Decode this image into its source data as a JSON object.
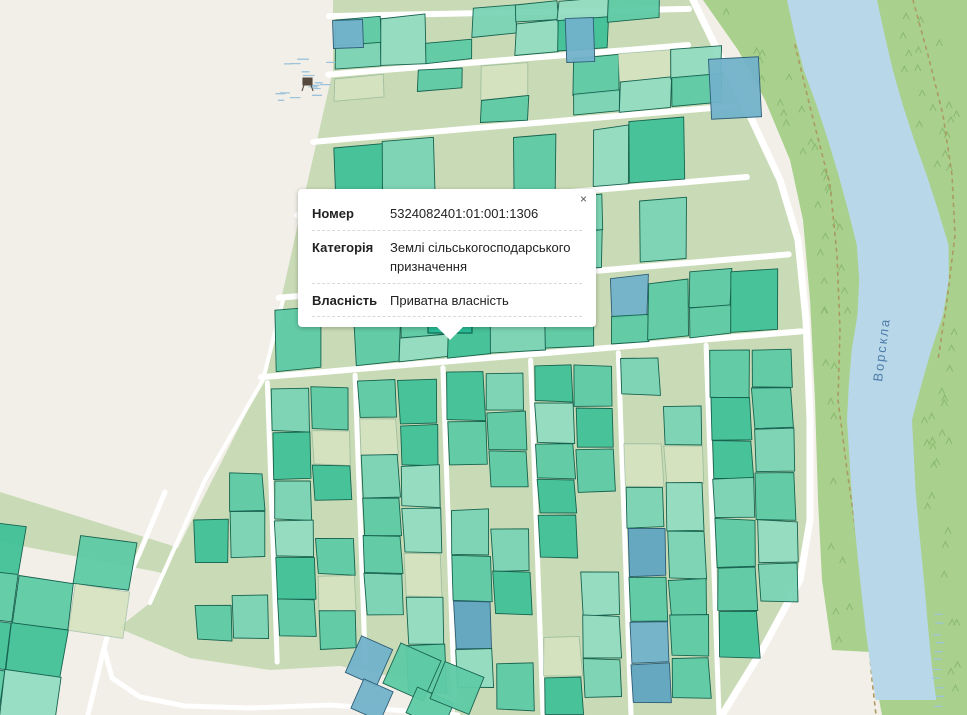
{
  "popup": {
    "close_label": "×",
    "rows": [
      {
        "label": "Номер",
        "value": "5324082401:01:001:1306"
      },
      {
        "label": "Категорія",
        "value": "Землі сільськогосподарського призначення"
      },
      {
        "label": "Власність",
        "value": "Приватна власність"
      }
    ]
  },
  "map": {
    "river_label": "Ворскла",
    "colors": {
      "background": "#f2efe8",
      "sage": "#c9dbb6",
      "sage_cell": "#d6e3c1",
      "forest": "#a9d18d",
      "river": "#b8d7e8",
      "road": "#ffffff",
      "parcel_teal": "#5ecaa5",
      "parcel_teal_light": "#7ad4b5",
      "parcel_teal_lighter": "#92dcc2",
      "parcel_teal_dark": "#41c198",
      "parcel_selected": "#2abf97",
      "parcel_stroke": "#17634f",
      "parcel_blue": "#72b2ca",
      "parcel_blue_dark": "#60a5c1",
      "parcel_blue_stroke": "#2e5d76",
      "path_dashed": "#ab9a62",
      "tree": "#8cba72",
      "marsh": "#9cc3da",
      "river_label_color": "#3c6e9f",
      "icon_dark": "#54493c"
    },
    "territory": [
      [
        333,
        0
      ],
      [
        333,
        70
      ],
      [
        300,
        215
      ],
      [
        263,
        380
      ],
      [
        150,
        603
      ],
      [
        118,
        628
      ],
      [
        190,
        658
      ],
      [
        270,
        670
      ],
      [
        340,
        666
      ],
      [
        420,
        682
      ],
      [
        455,
        700
      ],
      [
        455,
        715
      ],
      [
        722,
        715
      ],
      [
        762,
        650
      ],
      [
        800,
        580
      ],
      [
        810,
        520
      ],
      [
        810,
        420
      ],
      [
        806,
        320
      ],
      [
        798,
        240
      ],
      [
        780,
        180
      ],
      [
        752,
        120
      ],
      [
        722,
        60
      ],
      [
        693,
        0
      ]
    ],
    "cluster_band": [
      [
        0,
        492
      ],
      [
        170,
        545
      ],
      [
        270,
        588
      ],
      [
        358,
        624
      ],
      [
        360,
        654
      ],
      [
        255,
        610
      ],
      [
        158,
        572
      ],
      [
        0,
        542
      ]
    ],
    "forest_left_edge_yx": [
      [
        0,
        703
      ],
      [
        50,
        738
      ],
      [
        100,
        765
      ],
      [
        160,
        790
      ],
      [
        220,
        803
      ],
      [
        300,
        810
      ],
      [
        400,
        815
      ],
      [
        500,
        818
      ],
      [
        580,
        822
      ],
      [
        650,
        832
      ]
    ],
    "forest_close": [
      [
        870,
        652
      ],
      [
        882,
        715
      ],
      [
        967,
        715
      ],
      [
        967,
        0
      ]
    ],
    "river_left_yx": [
      [
        0,
        787
      ],
      [
        60,
        800
      ],
      [
        120,
        822
      ],
      [
        190,
        843
      ],
      [
        250,
        858
      ],
      [
        300,
        860
      ],
      [
        360,
        850
      ],
      [
        420,
        847
      ],
      [
        500,
        852
      ],
      [
        580,
        860
      ],
      [
        650,
        868
      ],
      [
        715,
        878
      ]
    ],
    "river_right_yx": [
      [
        0,
        877
      ],
      [
        60,
        890
      ],
      [
        120,
        907
      ],
      [
        190,
        932
      ],
      [
        250,
        950
      ],
      [
        300,
        948
      ],
      [
        360,
        928
      ],
      [
        420,
        912
      ],
      [
        500,
        916
      ],
      [
        580,
        924
      ],
      [
        650,
        930
      ],
      [
        715,
        938
      ]
    ],
    "road_right_edge_yx": [
      [
        0,
        693
      ],
      [
        60,
        722
      ],
      [
        120,
        752
      ],
      [
        180,
        780
      ],
      [
        240,
        798
      ],
      [
        320,
        806
      ],
      [
        420,
        810
      ],
      [
        520,
        810
      ],
      [
        580,
        800
      ],
      [
        650,
        762
      ],
      [
        715,
        722
      ]
    ],
    "dashed_paths": [
      [
        [
          795,
          45
        ],
        [
          812,
          115
        ],
        [
          830,
          185
        ],
        [
          837,
          255
        ],
        [
          840,
          330
        ],
        [
          838,
          400
        ],
        [
          847,
          470
        ],
        [
          857,
          540
        ],
        [
          866,
          610
        ],
        [
          872,
          680
        ],
        [
          876,
          715
        ]
      ],
      [
        [
          913,
          0
        ],
        [
          928,
          55
        ],
        [
          943,
          115
        ],
        [
          952,
          175
        ],
        [
          955,
          235
        ],
        [
          947,
          300
        ],
        [
          938,
          360
        ]
      ]
    ],
    "strip_roads": [
      {
        "yb": 16,
        "slope": -0.02
      },
      {
        "yb": 74,
        "slope": -0.082
      },
      {
        "yb": 140,
        "slope": -0.085
      },
      {
        "yb": 212,
        "slope": -0.085
      },
      {
        "yb": 293,
        "slope": -0.085
      },
      {
        "yb": 371,
        "slope": -0.085
      }
    ],
    "strips": [
      {
        "seed": 11,
        "yb": 70,
        "slope": -0.082,
        "h": 50,
        "x0": 335,
        "x1": 690,
        "skip": 0.2,
        "blue": 0.03,
        "rows": 2
      },
      {
        "seed": 22,
        "yb": 136,
        "slope": -0.085,
        "h": 58,
        "x0": 335,
        "x1": 765,
        "skip": 0.15,
        "blue": 0.04,
        "rows": 2
      },
      {
        "seed": 33,
        "yb": 208,
        "slope": -0.085,
        "h": 64,
        "x0": 335,
        "x1": 792,
        "skip": 0.5,
        "blue": 0.02,
        "rows": 1
      },
      {
        "seed": 44,
        "yb": 289,
        "slope": -0.085,
        "h": 72,
        "x0": 300,
        "x1": 800,
        "skip": 0.45,
        "blue": 0.03,
        "rows": 2
      },
      {
        "seed": 55,
        "yb": 367,
        "slope": -0.085,
        "h": 66,
        "x0": 276,
        "x1": 804,
        "skip": 0.08,
        "blue": 0.02,
        "rows": 2
      }
    ],
    "streets": [
      268,
      356,
      444,
      532,
      620,
      708
    ],
    "blocks": [
      {
        "seed": 101,
        "x": 186,
        "w": 76
      },
      {
        "seed": 102,
        "x": 268,
        "w": 82
      },
      {
        "seed": 103,
        "x": 356,
        "w": 82
      },
      {
        "seed": 104,
        "x": 444,
        "w": 82
      },
      {
        "seed": 105,
        "x": 532,
        "w": 82
      },
      {
        "seed": 106,
        "x": 620,
        "w": 82
      },
      {
        "seed": 107,
        "x": 708,
        "w": 86
      }
    ],
    "block_params": {
      "skip": 0.16,
      "blue": 0.05,
      "sagecell": 0.1,
      "tilt": 0.035
    },
    "trail": [
      [
        283,
        300
      ],
      [
        263,
        380
      ],
      [
        205,
        480
      ],
      [
        150,
        603
      ]
    ],
    "bl_roads": [
      [
        [
          165,
          492
        ],
        [
          140,
          552
        ],
        [
          118,
          600
        ],
        [
          104,
          648
        ],
        [
          112,
          678
        ],
        [
          140,
          697
        ],
        [
          185,
          706
        ],
        [
          250,
          708
        ],
        [
          330,
          705
        ],
        [
          420,
          712
        ],
        [
          458,
          715
        ]
      ],
      [
        [
          104,
          648
        ],
        [
          94,
          690
        ],
        [
          88,
          715
        ]
      ]
    ],
    "cluster": {
      "seed": 201,
      "ox": -30,
      "oy": 520,
      "cols": 7,
      "rows": 5,
      "cw": 56,
      "ch": 48,
      "rot": 8,
      "skip": 0.15,
      "sagecell": 0.12
    },
    "extra_parcels": [
      {
        "x": 333,
        "y": 20,
        "w": 30,
        "h": 28,
        "rot": -2,
        "type": "blue"
      },
      {
        "x": 566,
        "y": 18,
        "w": 28,
        "h": 44,
        "rot": -2,
        "type": "blue"
      },
      {
        "x": 710,
        "y": 58,
        "w": 50,
        "h": 60,
        "rot": -3,
        "type": "blue"
      },
      {
        "x": 352,
        "y": 641,
        "w": 34,
        "h": 40,
        "rot": 24,
        "type": "blue"
      },
      {
        "x": 356,
        "y": 684,
        "w": 32,
        "h": 32,
        "rot": 24,
        "type": "blue"
      },
      {
        "x": 390,
        "y": 650,
        "w": 44,
        "h": 44,
        "rot": 24,
        "type": "teal"
      },
      {
        "x": 410,
        "y": 694,
        "w": 40,
        "h": 28,
        "rot": 24,
        "type": "teal"
      },
      {
        "x": 436,
        "y": 668,
        "w": 42,
        "h": 40,
        "rot": 22,
        "type": "teal"
      }
    ],
    "selected_parcel": {
      "x": 428,
      "y": 295,
      "w": 44,
      "h": 38
    },
    "marsh_area": {
      "cx": 302,
      "cy": 80,
      "rx": 26,
      "ry": 27,
      "count": 16
    },
    "tree_counts": {
      "left_bank": 38,
      "right_bank": 44
    },
    "river_hatch": {
      "x": 931,
      "y0": 614,
      "count": 11,
      "step": 9
    }
  }
}
